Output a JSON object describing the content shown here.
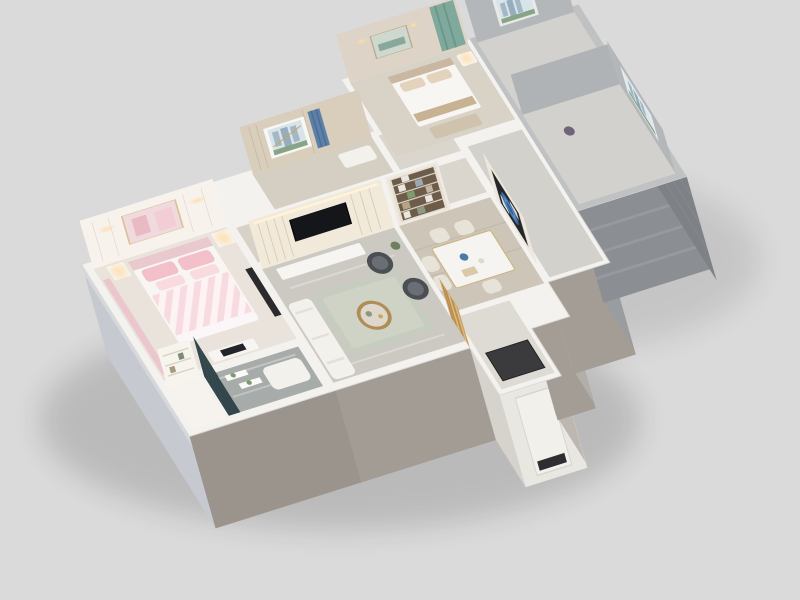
{
  "scene": {
    "title": "3D apartment floor-plan cutaway rendering",
    "style": "isometric dollhouse view of a furnished apartment on a neutral gray studio backdrop",
    "rooms": [
      {
        "name": "master-bedroom",
        "features": "pink upholstered bed with striped duvet, white panelled headboard wall with blush artwork, two nightstands with lit lamps, pink curtains, white dresser with small TV"
      },
      {
        "name": "wardrobe-niche",
        "features": "built-in white shelving unit with decor"
      },
      {
        "name": "foyer-bathroom",
        "features": "gray marble floor, dark teal feature wall, floating white shelves with plants, white chaise"
      },
      {
        "name": "living-room",
        "features": "cream slatted media wall with wall-mounted TV, white media console, round brass coffee table, two charcoal rattan armchairs, pale sage rug, white sofa"
      },
      {
        "name": "inner-corridor",
        "features": "wood floor passage behind the media wall"
      },
      {
        "name": "study",
        "features": "wood panelled wall, picture window with city view, blue curtain, white daybed"
      },
      {
        "name": "dining-room",
        "features": "white marble dining table, four cream chairs, full-height bookshelf with books, large blue-rose artwork on the wall"
      },
      {
        "name": "entry-porch",
        "features": "recessed white entry volume with door and dark doormat"
      },
      {
        "name": "hallway",
        "features": "gray tiled circulation space"
      },
      {
        "name": "second-bedroom",
        "features": "beige bed with white duvet, abstract artwork above headboard, sage-teal curtains, white nightstand with warm lamp"
      },
      {
        "name": "unfinished-room-north",
        "features": "bare concrete-gray walls, window with skyline and greenery view"
      },
      {
        "name": "unfinished-room-east",
        "features": "bare concrete-gray walls, window with skyline view, small purple plant"
      },
      {
        "name": "gold-partition",
        "features": "brass slatted decorative screen beside the entry"
      }
    ]
  },
  "palette": {
    "background": "#dadada",
    "shadow": "#1b1b1b",
    "wall_top": "#f3f2ef",
    "wall_top_gray": "#bfc1c3",
    "facade_west": "#c6cad0",
    "facade_south": "#9b948c",
    "facade_south2": "#a49d95",
    "facade_step": "#b3aea7",
    "facade_entry": "#e9e7e2",
    "facade_entry_side": "#d6d3cd",
    "facade_entry_shade": "#bcb8b1",
    "facade_gray_side": "#999da0",
    "brick_south": "#8b8f93",
    "brick_east": "#7e8286",
    "floor_bedroom": "#e9e3dc",
    "floor_niche": "#f6f3ee",
    "floor_bath_marble": "#a7acaa",
    "floor_living": "#ccc9c2",
    "floor_corridor": "#d7d1c7",
    "floor_study": "#d5cec3",
    "floor_small_room": "#dbd6cd",
    "floor_dining": "#cdc5b8",
    "floor_entry": "#dedbd4",
    "floor_hall": "#d3d1cb",
    "floor_bedroom2": "#d9d2c6",
    "floor_bare": "#d2d1ce",
    "rug_living": "#c7ccc0",
    "bed_white": "#f8f6f3",
    "bed_pink": "#f3bfc8",
    "sofa_white": "#f3f1ec",
    "armchair_dark": "#4b4f54",
    "coffee_table_gold": "#b08d55",
    "console_white": "#f7f5f1",
    "dining_table": "#f6f4f0",
    "chair_cream": "#e8e3d9",
    "doormat": "#3b3b3d",
    "panel_wall": "#f8f2ec",
    "panel_art_pink": "#f0dade",
    "tv_wall": "#f1e9da",
    "tv_screen": "#14161a",
    "bookshelf_wall": "#efe9df",
    "bookshelf_frame": "#e6dfd2",
    "bookshelf_back": "#6e5c4a",
    "art_wall": "#ece7df",
    "rose_art_bg": "#23262c",
    "wood_wall": "#d9cdbb",
    "blue_curtain": "#5d80a8",
    "bedroom2_wall": "#ddd3c6",
    "teal_curtain": "#7fa99c",
    "gray_inner_wall": "#b4b7b9",
    "gold_screen": "#caa264",
    "niche_face": "#f7f4ee",
    "teal_wall": "#32464b"
  }
}
